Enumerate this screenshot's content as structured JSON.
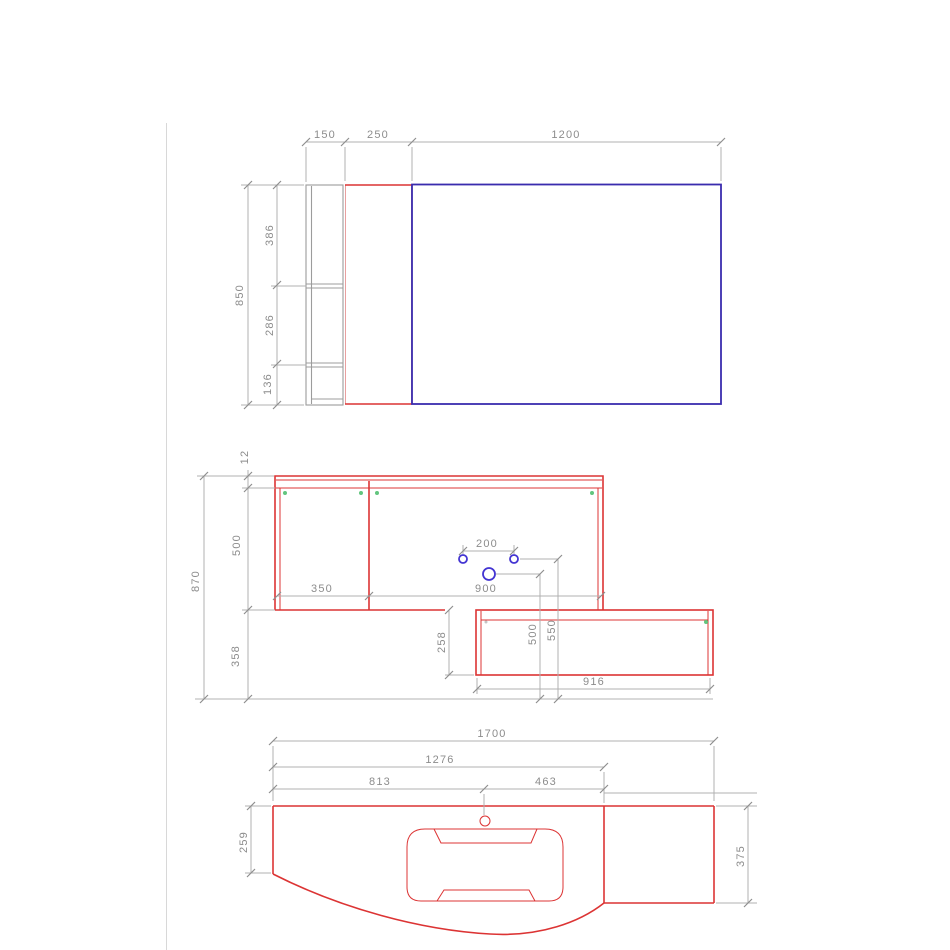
{
  "document": {
    "kind": "technical-drawing",
    "subject": "bathroom vanity unit - plan, front elevation and washbasin top views"
  },
  "colors": {
    "outline_red": "#dc3434",
    "mirror_blue": "#3a2cae",
    "hole_blue": "#4334d2",
    "hinge_green": "#62c57e",
    "dimension_gray": "#8c8c8c"
  },
  "views": {
    "top": {
      "shelf_width": "150",
      "side_panel_width": "250",
      "mirror_width": "1200",
      "total_height": "850",
      "segment_top": "386",
      "segment_middle": "286",
      "segment_bottom": "136"
    },
    "front": {
      "top_rail": "12",
      "cabinet_height": "500",
      "plinth_height": "358",
      "total_height": "870",
      "left_door_width": "350",
      "right_door_width": "900",
      "hole_spacing": "200",
      "drain_height": "500",
      "tap_hole_height": "550",
      "drawer_height": "258",
      "drawer_width": "916"
    },
    "bottom": {
      "total_width": "1700",
      "basin_span": "1276",
      "left_of_tap": "813",
      "right_of_tap": "463",
      "depth_left": "259",
      "depth_right": "375"
    }
  }
}
